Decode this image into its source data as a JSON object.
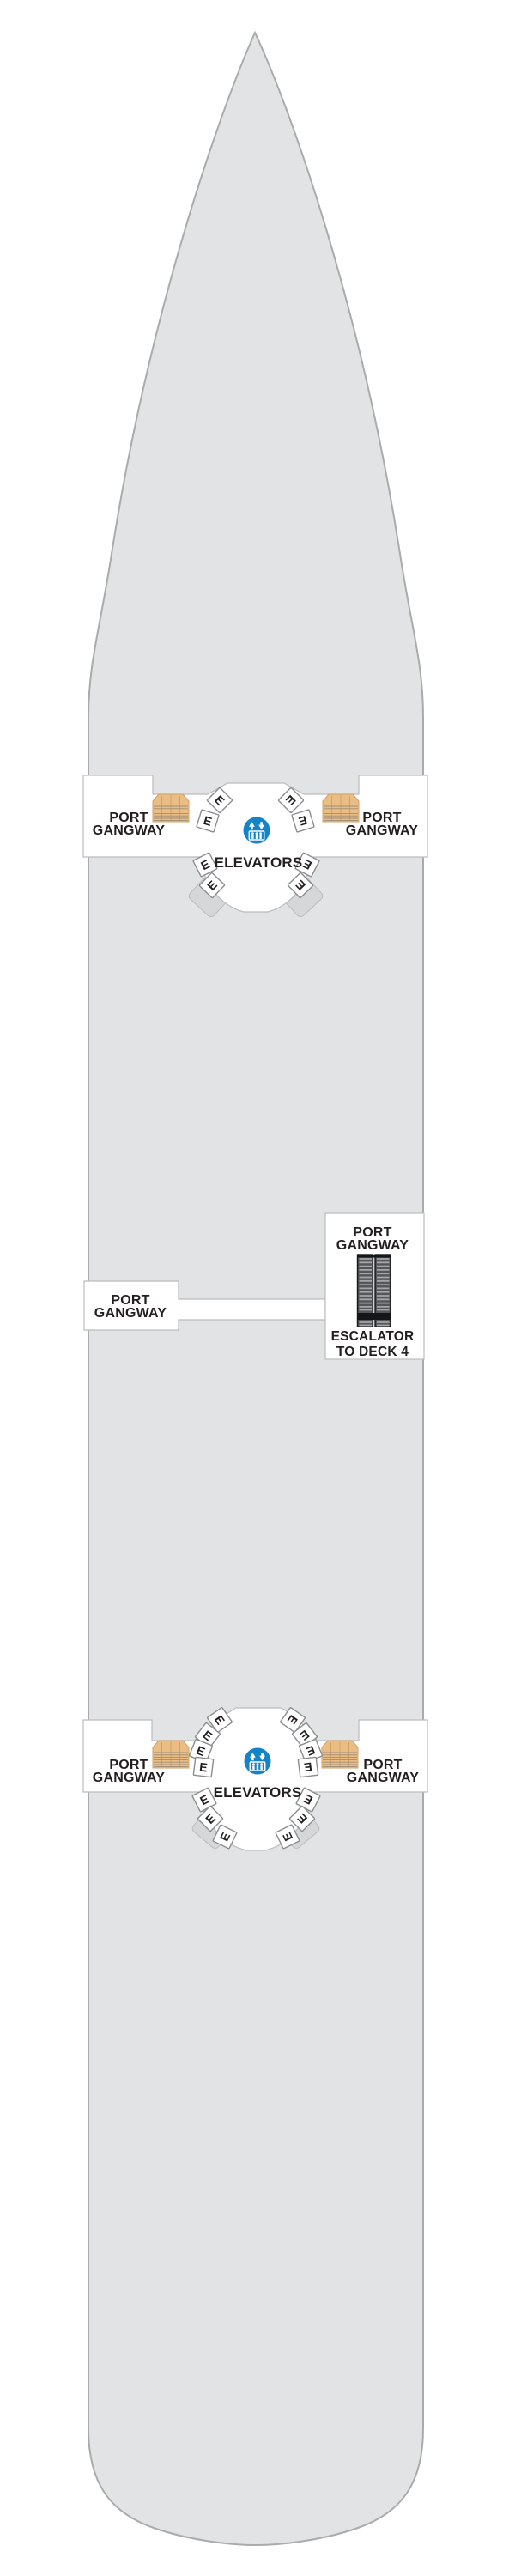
{
  "deck_plan": {
    "forward_lobby": {
      "port_gangway_left": {
        "line1": "PORT",
        "line2": "GANGWAY"
      },
      "port_gangway_right": {
        "line1": "PORT",
        "line2": "GANGWAY"
      },
      "elevators_label": "ELEVATORS",
      "elevator_door_label": "E",
      "elevator_door_count": 8
    },
    "midship_gangway": {
      "port_gangway_left": {
        "line1": "PORT",
        "line2": "GANGWAY"
      },
      "port_gangway_right": {
        "line1": "PORT",
        "line2": "GANGWAY"
      },
      "escalator": {
        "line1": "ESCALATOR",
        "line2": "TO DECK 4"
      }
    },
    "aft_lobby": {
      "port_gangway_left": {
        "line1": "PORT",
        "line2": "GANGWAY"
      },
      "port_gangway_right": {
        "line1": "PORT",
        "line2": "GANGWAY"
      },
      "elevators_label": "ELEVATORS",
      "elevator_door_label": "E",
      "elevator_door_count": 14
    },
    "icons": {
      "elevator_badge": "elevator-up-down-people-icon",
      "stairs": "gangway-stairs-icon",
      "escalator": "escalator-icon"
    },
    "colors": {
      "hull": "#e2e3e5",
      "hull_border": "#a9abad",
      "white": "#ffffff",
      "line": "#babcbe",
      "text": "#231f20",
      "stair": "#eabd85",
      "stair_border": "#d2a166",
      "stair_tread": "#9e8d76",
      "wedge": "#d6d7d9",
      "elevator_blue": "#1583c8",
      "ebox_border": "#8a8c8f",
      "escalator_body": "#55565a",
      "escalator_black": "#151618",
      "escalator_rung": "#a3a5a7"
    }
  }
}
